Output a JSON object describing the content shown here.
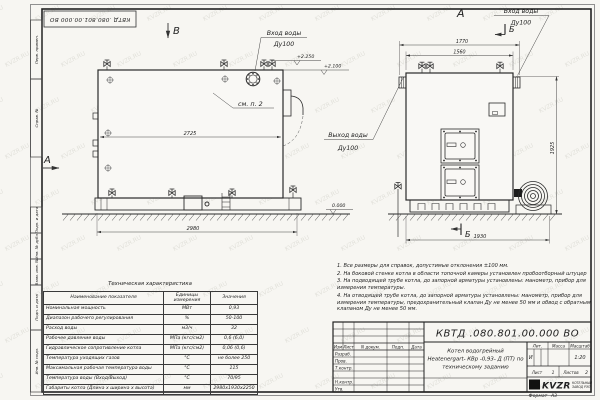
{
  "watermark": "KVZR.RU",
  "corner_stamp": "КВТД .080.801.00.000 ВО",
  "margin_labels": [
    "Перв. примен.",
    "Справ. №",
    "Подп. и дата",
    "Инв. № дубл.",
    "Взам. инв. №",
    "Подп. и дата",
    "Инв. № подл."
  ],
  "drawing": {
    "view_labels": {
      "top": "В",
      "left": "А",
      "front": "А"
    },
    "section_label": "Б",
    "callouts": {
      "inlet_left": {
        "line1": "Вход воды",
        "line2": "Ду100"
      },
      "inlet_right": {
        "line1": "Вход воды",
        "line2": "Ду100"
      },
      "outlet": {
        "line1": "Выход воды",
        "line2": "Ду100"
      },
      "see_note": "см. п. 2"
    },
    "elevations": {
      "e1": "+2.250",
      "e2": "+2.100",
      "e3": "0.000"
    },
    "dimensions": {
      "side_top": "2725",
      "side_bottom": "2980",
      "front_top_outer": "1770",
      "front_top_inner": "1560",
      "front_height": "1925",
      "front_bottom": "1930"
    }
  },
  "notes": [
    "1. Все размеры для справок, допустимые отклонения ±100 мм.",
    "2. На боковой стенке котла в области топочной камеры установлен пробоотборный штуцер",
    "3. На подводящей трубе котла, до запорной арматуры установлены: манометр, прибор для измерения температуры.",
    "4. На отводящей трубе котла, до запорной арматуры установлены: манометр, прибор для измерения температуры, предохранительный клапан Ду не менее 50 мм и обвод с обратным клапаном Ду не менее 50 мм."
  ],
  "tech_table": {
    "title": "Техническая характеристика",
    "headers": [
      "Наименование показателя",
      "Единицы измерения",
      "Значения"
    ],
    "rows": [
      [
        "Номинальная мощность",
        "МВт",
        "0,93"
      ],
      [
        "Диапазон рабочего регулирования",
        "%",
        "50-100"
      ],
      [
        "Расход воды",
        "м3/ч",
        "32"
      ],
      [
        "Рабочее давление воды",
        "МПа (кгс/см2)",
        "0,6 (6,0)"
      ],
      [
        "Гидравлическое сопротивление котла",
        "МПа (кгс/см2)",
        "0,06 (0,6)"
      ],
      [
        "Температура уходящих газов",
        "°С",
        "не более 250"
      ],
      [
        "Максимальная рабочая температура воды",
        "°С",
        "115"
      ],
      [
        "Температура воды (Вход/Выход)",
        "°С",
        "70/95"
      ],
      [
        "Габариты котла (Длина х ширина х высота)",
        "мм",
        "2980х1930х2250"
      ]
    ]
  },
  "title_block": {
    "doc_number": "КВТД .080.801.00.000  ВО",
    "product_name": [
      "Котел водогрейный",
      "Heatenergart- КВр -0,93- Д (ПТ) по",
      "техническому заданию"
    ],
    "change_headers": [
      "Изм",
      "Лист",
      "N докум.",
      "Подп.",
      "Дата"
    ],
    "roles": [
      "Разраб.",
      "Пров.",
      "Т.контр.",
      "Н.контр.",
      "Утв."
    ],
    "lit_header": "Лит.",
    "mass_header": "Масса",
    "scale_header": "Масштаб",
    "lit_value": "И",
    "scale_value": "1:20",
    "sheet_label": "Лист",
    "sheet_value": "1",
    "sheets_label": "Листов",
    "sheets_value": "2",
    "logo_text": "KVZR",
    "logo_sub1": "КОТЕЛЬНЫЙ",
    "logo_sub2": "ЗАВОД РЭП",
    "format_label": "Формат",
    "format_value": "А3"
  }
}
